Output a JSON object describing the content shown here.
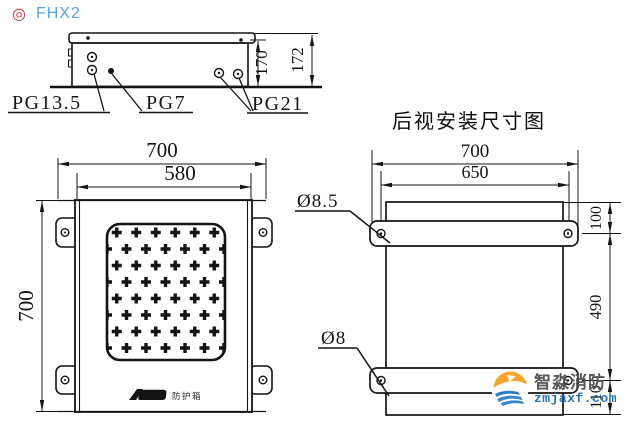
{
  "header": {
    "bullet_icon": "◎",
    "product_code": "FHX2"
  },
  "top_view": {
    "labels": {
      "gland_left": "PG13.5",
      "gland_mid": "PG7",
      "gland_right": "PG21"
    },
    "dims": {
      "body_depth": "170",
      "total_depth": "172"
    }
  },
  "front_view": {
    "dims": {
      "overall_width": "700",
      "face_width": "580",
      "overall_height": "700"
    },
    "nameplate_text": "防护箱"
  },
  "rear_view": {
    "title": "后视安装尺寸图",
    "dims": {
      "overall_width": "700",
      "hole_spacing_h": "650",
      "top_offset": "100",
      "hole_spacing_v": "490",
      "bottom_offset": "110"
    },
    "labels": {
      "hole_top": "Ø8.5",
      "hole_bottom": "Ø8"
    }
  },
  "watermark": {
    "brand": "智淼消防",
    "domain": "zmjaxf.com"
  }
}
